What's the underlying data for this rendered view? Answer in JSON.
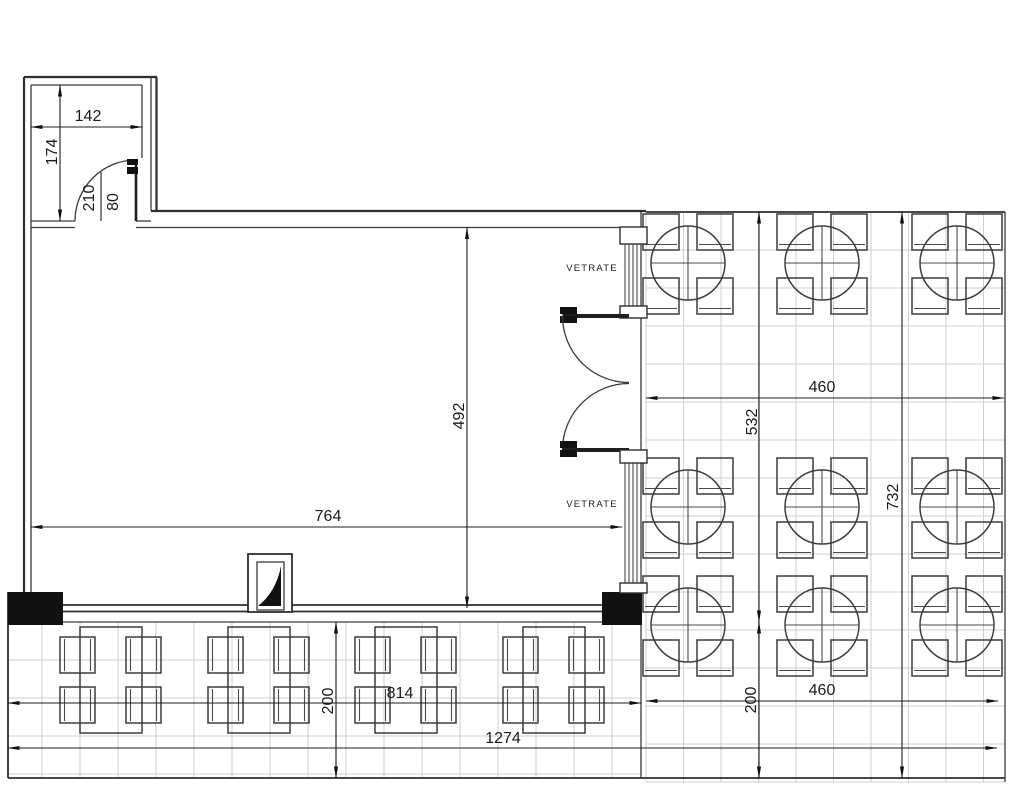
{
  "drawing": {
    "type": "floor-plan",
    "labels": {
      "glazing_top": "VETRATE",
      "glazing_bottom": "VETRATE"
    },
    "dimensions": {
      "vestibule_width": "142",
      "vestibule_depth": "174",
      "door_height": "210",
      "door_width": "80",
      "hall_depth": "492",
      "hall_width": "764",
      "right_terrace_width_top": "460",
      "right_terrace_upper_height": "532",
      "right_terrace_total_height": "732",
      "left_terrace_depth": "200",
      "left_terrace_width": "814",
      "total_width": "1274",
      "right_terrace_width_bottom": "460",
      "right_terrace_depth": "200"
    },
    "colors": {
      "ink": "#2e2e2e",
      "grid_line": "#cfcfcf",
      "paper": "#ffffff",
      "solid_fill": "#111111"
    },
    "furniture": {
      "round_tables_count": 9,
      "rect_tables_count": 4
    }
  }
}
